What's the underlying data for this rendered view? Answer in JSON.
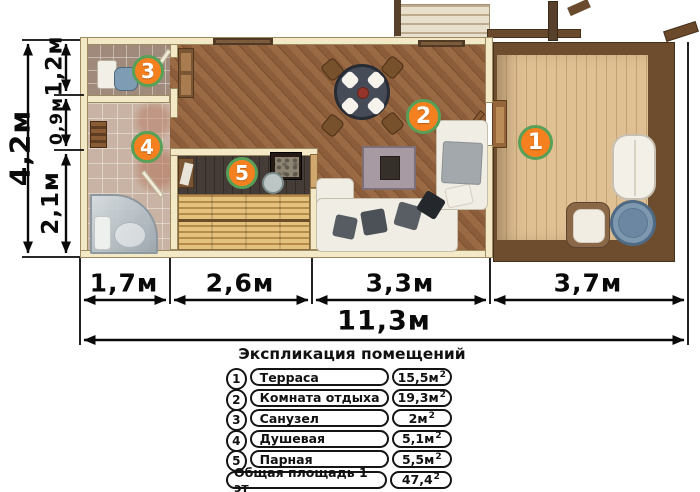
{
  "plan": {
    "badges": [
      {
        "label": "1"
      },
      {
        "label": "2"
      },
      {
        "label": "3"
      },
      {
        "label": "4"
      },
      {
        "label": "5"
      }
    ]
  },
  "dimensions": {
    "left": {
      "total": "4,2м",
      "seg1": "1,2м",
      "seg2": "0,9м",
      "seg3": "2,1м"
    },
    "bottom": {
      "seg1": "1,7м",
      "seg2": "2,6м",
      "seg3": "3,3м",
      "seg4": "3,7м",
      "total": "11,3м"
    }
  },
  "legend": {
    "title": "Экспликация помещений",
    "rows": [
      {
        "num": "1",
        "name": "Терраса",
        "area": "15,5м",
        "sup": "2"
      },
      {
        "num": "2",
        "name": "Комната отдыха",
        "area": "19,3м",
        "sup": "2"
      },
      {
        "num": "3",
        "name": "Санузел",
        "area": "2м",
        "sup": "2"
      },
      {
        "num": "4",
        "name": "Душевая",
        "area": "5,1м",
        "sup": "2"
      },
      {
        "num": "5",
        "name": "Парная",
        "area": "5,5м",
        "sup": "2"
      },
      {
        "num": "",
        "name": "Общая площадь 1 эт",
        "area": "47,4",
        "sup": "2"
      }
    ]
  },
  "colors": {
    "badge_fill": "#f5801f",
    "badge_border": "#58a058",
    "wall": "#f3e9c6",
    "deck": "#dfc093",
    "wood_floor": "#8c5d3a"
  }
}
